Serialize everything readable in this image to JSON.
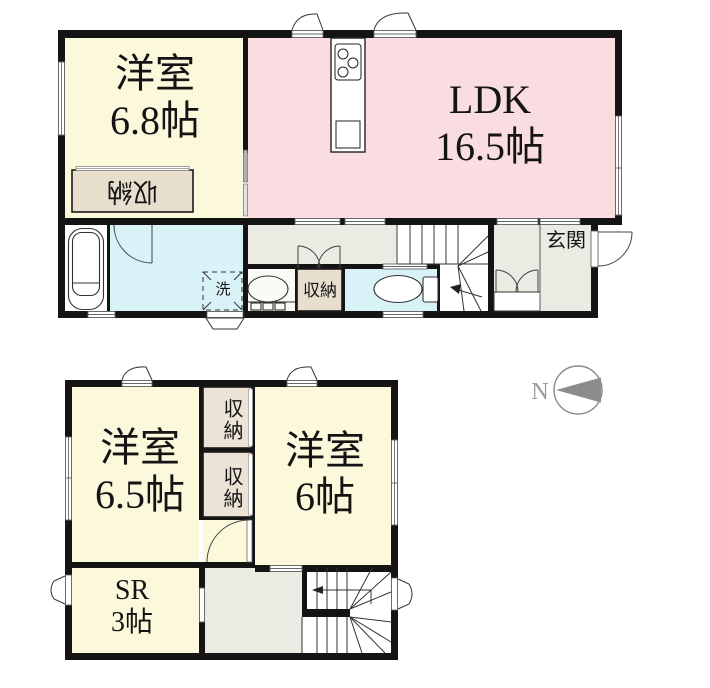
{
  "floor1": {
    "room_west": {
      "name": "洋室",
      "size": "6.8帖"
    },
    "ldk": {
      "name": "LDK",
      "size": "16.5帖"
    },
    "closet_label": "収納",
    "hall_closet_label": "収納",
    "laundry_label": "洗",
    "entrance_label": "玄関"
  },
  "floor2": {
    "room_west": {
      "name": "洋室",
      "size": "6.5帖"
    },
    "room_east": {
      "name": "洋室",
      "size": "6帖"
    },
    "closet_upper_label": "収納",
    "closet_lower_label": "収納",
    "service_room": {
      "name": "SR",
      "size": "3帖"
    }
  },
  "compass": {
    "north_label": "N"
  },
  "colors": {
    "room_cream": "#FBF8DC",
    "ldk_pink": "#FADDE1",
    "wet_cyan": "#D9F2F7",
    "hall_gray": "#EAEBE3",
    "closet_tan": "#E8DECE",
    "closet_tan_2f": "#EDE2D6",
    "wall": "#141414",
    "compass_gray": "#8C8C8C"
  }
}
